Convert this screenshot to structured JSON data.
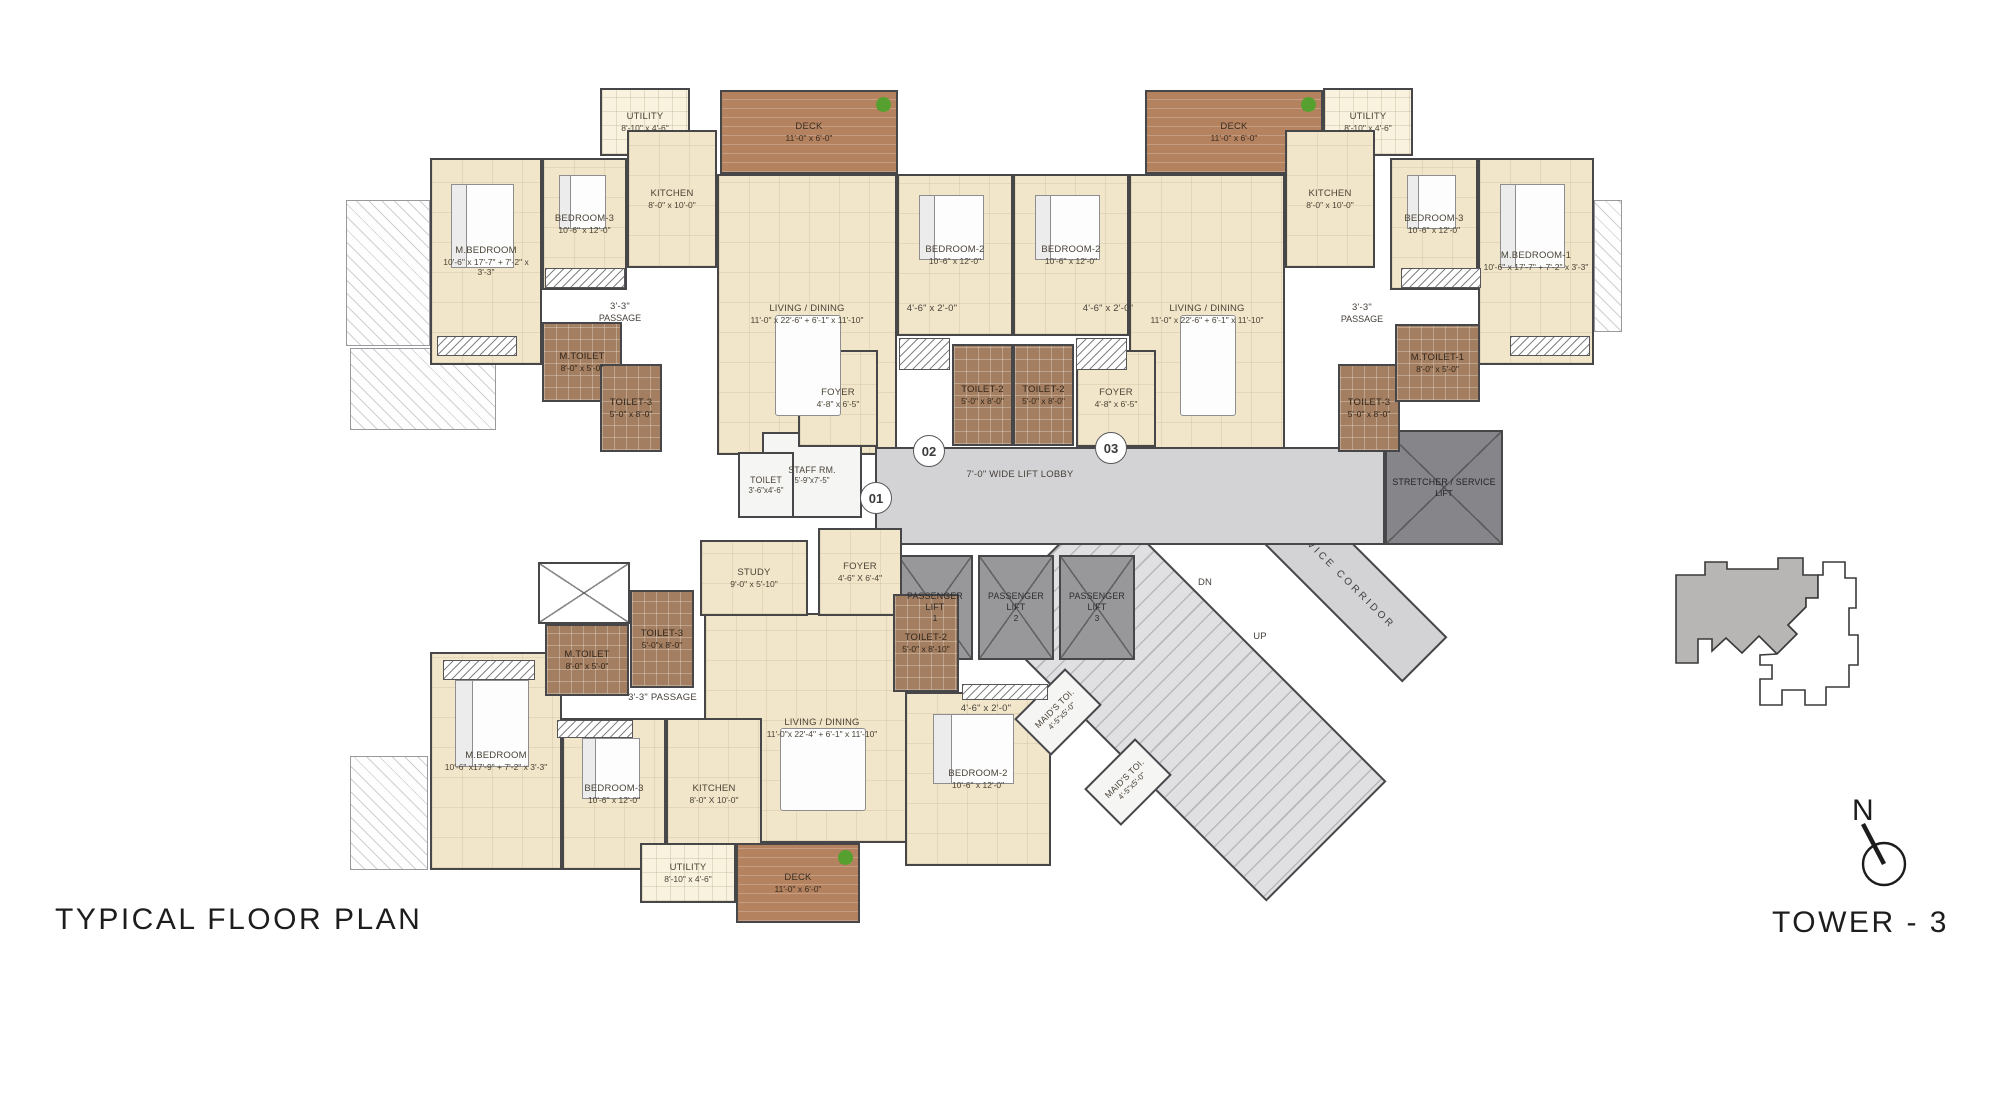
{
  "title": "TYPICAL FLOOR PLAN",
  "tower": "TOWER - 3",
  "north": "N",
  "palette": {
    "floor": "#f2e6ca",
    "deck": "#b4825f",
    "toilet_tile": "#a47e60",
    "wall": "#47474a",
    "lobby": "#d3d3d5",
    "lift": "#98989b",
    "keyplan_highlight": "#b8b6b5",
    "plant": "#56a02f"
  },
  "unit_markers": [
    {
      "id": "01",
      "x": 875,
      "y": 497
    },
    {
      "id": "02",
      "x": 928,
      "y": 450
    },
    {
      "id": "03",
      "x": 1110,
      "y": 447
    }
  ],
  "rooms": [
    {
      "nm": "balcony-ledge",
      "t": "ledge",
      "x": 346,
      "y": 200,
      "w": 84,
      "h": 146
    },
    {
      "nm": "balcony-ledge",
      "t": "ledge",
      "x": 350,
      "y": 348,
      "w": 146,
      "h": 82
    },
    {
      "nm": "balcony-ledge",
      "t": "ledge",
      "x": 350,
      "y": 756,
      "w": 78,
      "h": 114
    },
    {
      "nm": "balcony-ledge",
      "t": "ledge",
      "x": 1594,
      "y": 200,
      "w": 28,
      "h": 132
    },
    {
      "n": "UTILITY",
      "d": "8'-10\" x 4'-6\"",
      "t": "utility",
      "x": 600,
      "y": 88,
      "w": 90,
      "h": 68
    },
    {
      "n": "DECK",
      "d": "11'-0\" x 6'-0\"",
      "t": "deck",
      "x": 720,
      "y": 90,
      "w": 178,
      "h": 84
    },
    {
      "n": "M.BEDROOM",
      "d": "10'-6\" x 17'-7\" + 7'-2\" x 3'-3\"",
      "t": "floor",
      "x": 430,
      "y": 158,
      "w": 112,
      "h": 207,
      "f": "bed"
    },
    {
      "n": "BEDROOM-3",
      "d": "10'-6\" x 12'-0\"",
      "t": "floor",
      "x": 542,
      "y": 158,
      "w": 85,
      "h": 132,
      "f": "bed"
    },
    {
      "n": "KITCHEN",
      "d": "8'-0\" x 10'-0\"",
      "t": "floor",
      "x": 627,
      "y": 130,
      "w": 90,
      "h": 138
    },
    {
      "n": "LIVING / DINING",
      "d": "11'-0\" x 22'-6\" + 6'-1\" x 11'-10\"",
      "t": "floor",
      "x": 717,
      "y": 174,
      "w": 180,
      "h": 281,
      "f": "table"
    },
    {
      "n": "BEDROOM-2",
      "d": "10'-6\" x 12'-0\"",
      "t": "floor",
      "x": 897,
      "y": 174,
      "w": 116,
      "h": 162,
      "f": "bed"
    },
    {
      "n": "DECK",
      "d": "11'-0\" x 6'-0\"",
      "t": "deck",
      "x": 1145,
      "y": 90,
      "w": 178,
      "h": 84
    },
    {
      "n": "UTILITY",
      "d": "8'-10\" x 4'-6\"",
      "t": "utility",
      "x": 1323,
      "y": 88,
      "w": 90,
      "h": 68
    },
    {
      "n": "BEDROOM-2",
      "d": "10'-6\" x 12'-0\"",
      "t": "floor",
      "x": 1013,
      "y": 174,
      "w": 116,
      "h": 162,
      "f": "bed"
    },
    {
      "n": "LIVING / DINING",
      "d": "11'-0\" x 22'-6\" + 6'-1\" x 11'-10\"",
      "t": "floor",
      "x": 1129,
      "y": 174,
      "w": 156,
      "h": 281,
      "f": "table"
    },
    {
      "n": "KITCHEN",
      "d": "8'-0\" x 10'-0\"",
      "t": "floor",
      "x": 1285,
      "y": 130,
      "w": 90,
      "h": 138
    },
    {
      "n": "BEDROOM-3",
      "d": "10'-6\" x 12'-0\"",
      "t": "floor",
      "x": 1390,
      "y": 158,
      "w": 88,
      "h": 132,
      "f": "bed"
    },
    {
      "n": "M.BEDROOM-1",
      "d": "10'-6\" x 17'-7\" + 7'-2\" x 3'-3\"",
      "t": "floor",
      "x": 1478,
      "y": 158,
      "w": 116,
      "h": 207,
      "f": "bed"
    },
    {
      "n": "LIVING / DINING",
      "d": "11'-0\"x 22'-4\" + 6'-1\" x 11'-10\"",
      "t": "floor",
      "x": 704,
      "y": 613,
      "w": 236,
      "h": 230,
      "f": "table"
    },
    {
      "n": "M.BEDROOM",
      "d": "10'-6\" x17'-9\" + 7'-2\" x 3'-3\"",
      "t": "floor",
      "x": 430,
      "y": 652,
      "w": 132,
      "h": 218,
      "f": "bed"
    },
    {
      "n": "BEDROOM-3",
      "d": "10'-6\" x 12'-0\"",
      "t": "floor",
      "x": 562,
      "y": 718,
      "w": 104,
      "h": 152,
      "f": "bed"
    },
    {
      "n": "KITCHEN",
      "d": "8'-0\" X 10'-0\"",
      "t": "floor",
      "x": 666,
      "y": 718,
      "w": 96,
      "h": 152
    },
    {
      "n": "UTILITY",
      "d": "8'-10\" x 4'-6\"",
      "t": "utility",
      "x": 640,
      "y": 843,
      "w": 96,
      "h": 60
    },
    {
      "n": "DECK",
      "d": "11'-0\" x 6'-0\"",
      "t": "deck",
      "x": 736,
      "y": 843,
      "w": 124,
      "h": 80
    },
    {
      "n": "BEDROOM-2",
      "d": "10'-6\" x 12'-0\"",
      "t": "floor",
      "x": 905,
      "y": 692,
      "w": 146,
      "h": 174,
      "f": "bed"
    },
    {
      "nm": "service-corridor",
      "n": "SERVICE CORRIDOR",
      "t": "corridor",
      "x": 1220,
      "y": 543,
      "w": 240,
      "h": 64,
      "r": 45
    },
    {
      "nm": "staircase",
      "t": "stairs",
      "x": 985,
      "y": 615,
      "w": 400,
      "h": 170,
      "r": 45
    },
    {
      "nm": "lift-lobby",
      "t": "lobby",
      "x": 875,
      "y": 447,
      "w": 510,
      "h": 98
    },
    {
      "nm": "stretcher-service-lift",
      "n": "STRETCHER / SERVICE",
      "d": "LIFT",
      "t": "liftdark",
      "x": 1385,
      "y": 430,
      "w": 118,
      "h": 115
    },
    {
      "nm": "passenger-lift-1",
      "n": "PASSENGER LIFT",
      "d": "1",
      "t": "lift",
      "x": 897,
      "y": 555,
      "w": 76,
      "h": 105
    },
    {
      "nm": "passenger-lift-2",
      "n": "PASSENGER LIFT",
      "d": "2",
      "t": "lift",
      "x": 978,
      "y": 555,
      "w": 76,
      "h": 105
    },
    {
      "nm": "passenger-lift-3",
      "n": "PASSENGER LIFT",
      "d": "3",
      "t": "lift",
      "x": 1059,
      "y": 555,
      "w": 76,
      "h": 105
    },
    {
      "n": "STAFF RM.",
      "d": "5'-9\"x7'-5\"",
      "t": "white",
      "x": 762,
      "y": 432,
      "w": 100,
      "h": 86
    },
    {
      "n": "TOILET",
      "d": "3'-6\"x4'-6\"",
      "t": "white",
      "x": 738,
      "y": 452,
      "w": 56,
      "h": 66
    },
    {
      "n": "STUDY",
      "d": "9'-0\" x 5'-10\"",
      "t": "floor",
      "x": 700,
      "y": 540,
      "w": 108,
      "h": 76
    },
    {
      "n": "FOYER",
      "d": "4'-6\" X 6'-4\"",
      "t": "floor",
      "x": 818,
      "y": 528,
      "w": 84,
      "h": 88
    },
    {
      "n": "M.TOILET",
      "d": "8'-0\" x 5'-0\"",
      "t": "toilet",
      "x": 542,
      "y": 322,
      "w": 80,
      "h": 80
    },
    {
      "n": "TOILET-3",
      "d": "5'-0\" x 8'-0\"",
      "t": "toilet",
      "x": 600,
      "y": 364,
      "w": 62,
      "h": 88
    },
    {
      "n": "FOYER",
      "d": "4'-8\" x 6'-5\"",
      "t": "floor",
      "x": 798,
      "y": 350,
      "w": 80,
      "h": 97
    },
    {
      "n": "TOILET-2",
      "d": "5'-0\" x 8'-0\"",
      "t": "toilet",
      "x": 952,
      "y": 344,
      "w": 61,
      "h": 102
    },
    {
      "n": "TOILET-2",
      "d": "5'-0\" x 8'-0\"",
      "t": "toilet",
      "x": 1013,
      "y": 344,
      "w": 61,
      "h": 102
    },
    {
      "n": "FOYER",
      "d": "4'-8\" x 6'-5\"",
      "t": "floor",
      "x": 1076,
      "y": 350,
      "w": 80,
      "h": 97
    },
    {
      "n": "TOILET-3",
      "d": "5'-0\" x 8'-0\"",
      "t": "toilet",
      "x": 1338,
      "y": 364,
      "w": 62,
      "h": 88
    },
    {
      "n": "M.TOILET-1",
      "d": "8'-0\" x 5'-0\"",
      "t": "toilet",
      "x": 1395,
      "y": 324,
      "w": 85,
      "h": 78
    },
    {
      "nm": "duct-shaft",
      "t": "shaft",
      "x": 538,
      "y": 562,
      "w": 92,
      "h": 62
    },
    {
      "n": "M.TOILET",
      "d": "8'-0\" x 5'-0\"",
      "t": "toilet",
      "x": 545,
      "y": 624,
      "w": 84,
      "h": 72
    },
    {
      "n": "TOILET-3",
      "d": "5'-0\"x 8'-0\"",
      "t": "toilet",
      "x": 630,
      "y": 590,
      "w": 64,
      "h": 98
    },
    {
      "n": "TOILET-2",
      "d": "5'-0\" x 8'-10\"",
      "t": "toilet",
      "x": 893,
      "y": 594,
      "w": 66,
      "h": 98
    },
    {
      "n": "MAID'S TOI.",
      "d": "4'-5\"x5'-0\"",
      "t": "white",
      "x": 1022,
      "y": 686,
      "w": 72,
      "h": 52,
      "r": -45
    },
    {
      "n": "MAID'S TOI.",
      "d": "4'-5\"x5'-0\"",
      "t": "white",
      "x": 1092,
      "y": 756,
      "w": 72,
      "h": 52,
      "r": -45
    },
    {
      "nm": "wardrobe",
      "t": "ward",
      "x": 437,
      "y": 336,
      "w": 80,
      "h": 20
    },
    {
      "nm": "wardrobe",
      "t": "ward",
      "x": 545,
      "y": 268,
      "w": 80,
      "h": 20
    },
    {
      "nm": "wardrobe",
      "t": "ward",
      "x": 899,
      "y": 338,
      "w": 51,
      "h": 32
    },
    {
      "nm": "wardrobe",
      "t": "ward",
      "x": 1076,
      "y": 338,
      "w": 51,
      "h": 32
    },
    {
      "nm": "wardrobe",
      "t": "ward",
      "x": 1401,
      "y": 268,
      "w": 80,
      "h": 20
    },
    {
      "nm": "wardrobe",
      "t": "ward",
      "x": 1510,
      "y": 336,
      "w": 80,
      "h": 20
    },
    {
      "nm": "wardrobe",
      "t": "ward",
      "x": 443,
      "y": 660,
      "w": 92,
      "h": 20
    },
    {
      "nm": "wardrobe",
      "t": "ward",
      "x": 557,
      "y": 720,
      "w": 76,
      "h": 18
    },
    {
      "nm": "wardrobe",
      "t": "ward",
      "x": 962,
      "y": 684,
      "w": 86,
      "h": 16
    },
    {
      "nm": "passage-label",
      "n": "3'-3\"",
      "d": "PASSAGE",
      "t": "label",
      "x": 580,
      "y": 295,
      "w": 80,
      "h": 34
    },
    {
      "nm": "passage-label",
      "n": "3'-3\"",
      "d": "PASSAGE",
      "t": "label",
      "x": 1322,
      "y": 296,
      "w": 80,
      "h": 34
    },
    {
      "nm": "passage-label",
      "n": "3'-3\" PASSAGE",
      "t": "label",
      "x": 615,
      "y": 690,
      "w": 95,
      "h": 16
    },
    {
      "nm": "wardrobe-dim-label",
      "n": "4'-6\" x 2'-0\"",
      "t": "label",
      "x": 877,
      "y": 302,
      "w": 110,
      "h": 14
    },
    {
      "nm": "wardrobe-dim-label",
      "n": "4'-6\" x 2'-0\"",
      "t": "label",
      "x": 1053,
      "y": 302,
      "w": 110,
      "h": 14
    },
    {
      "nm": "wardrobe-dim-label",
      "n": "4'-6\" x 2'-0\"",
      "t": "label",
      "x": 933,
      "y": 702,
      "w": 106,
      "h": 14
    },
    {
      "nm": "lift-lobby-label",
      "n": "7'-0\" WIDE LIFT LOBBY",
      "t": "label",
      "x": 930,
      "y": 466,
      "w": 180,
      "h": 18
    },
    {
      "nm": "stairs-dn-label",
      "n": "DN",
      "t": "label",
      "x": 1190,
      "y": 576,
      "w": 30,
      "h": 14
    },
    {
      "nm": "stairs-up-label",
      "n": "UP",
      "t": "label",
      "x": 1245,
      "y": 630,
      "w": 30,
      "h": 14
    }
  ]
}
